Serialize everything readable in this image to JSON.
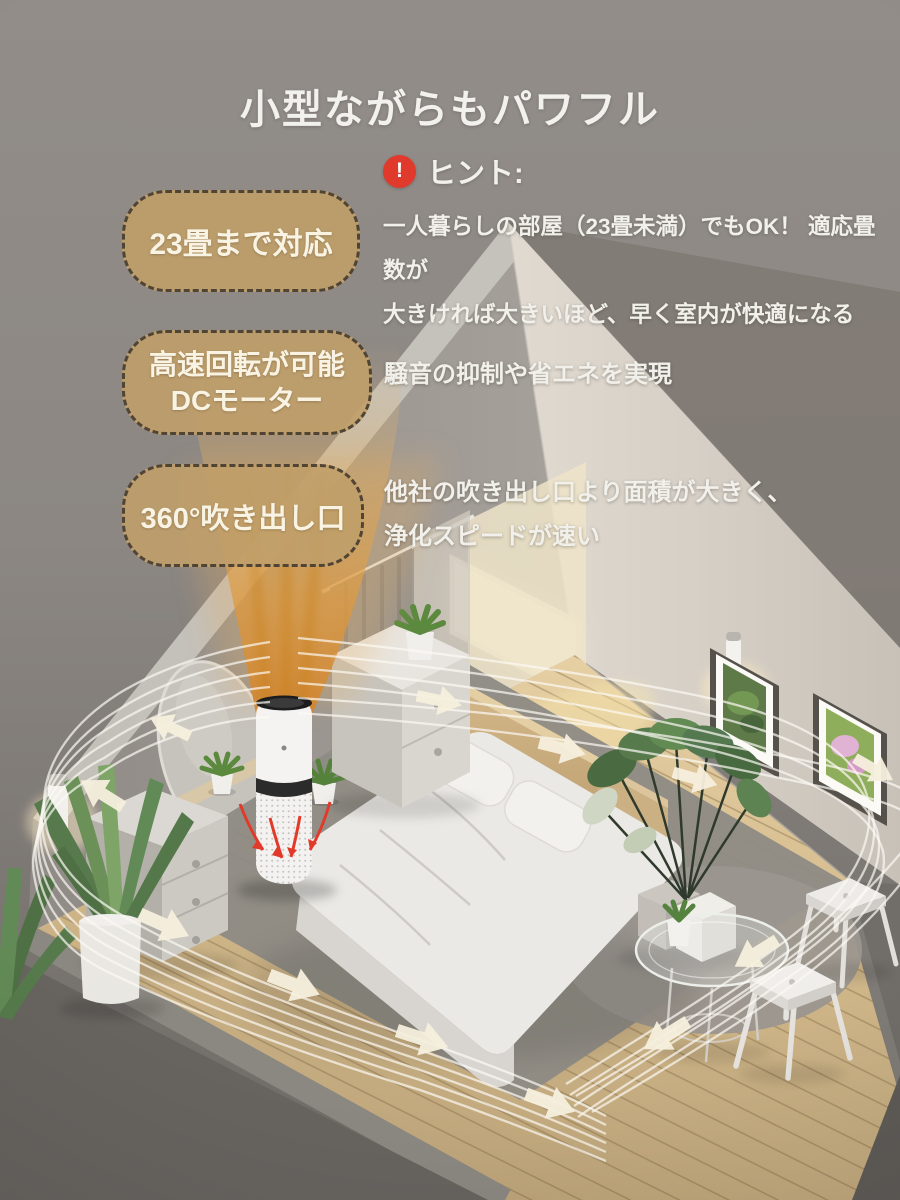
{
  "page": {
    "title": "小型ながらもパワフル"
  },
  "hint": {
    "icon": "exclamation-icon",
    "glyph": "!",
    "label": "ヒント:",
    "line1": "一人暮らしの部屋（23畳未満）でもOK！ 適応畳数が",
    "line2": "大きければ大きいほど、早く室内が快適になる"
  },
  "features": [
    {
      "badge_line1": "23畳まで対応",
      "badge_line2": "",
      "desc_line1": "",
      "desc_line2": ""
    },
    {
      "badge_line1": "高速回転が可能",
      "badge_line2": "DCモーター",
      "desc_line1": "騒音の抑制や省エネを実現",
      "desc_line2": ""
    },
    {
      "badge_line1": "360°吹き出し口",
      "badge_line2": "",
      "desc_line1": "他社の吹き出し口より面積が大きく、",
      "desc_line2": "浄化スピードが速い"
    }
  ],
  "colors": {
    "background_top": "#918c88",
    "background_bottom": "#6e6a66",
    "badge_fill": "#bf9e6a",
    "badge_border": "#3e3830",
    "badge_text": "#f9f3e3",
    "hint_red": "#e03a2c",
    "text_white": "#f2f0ea",
    "airflow_orange": "#de9a3c",
    "streamline_white": "#fcfaf4",
    "floor_wood": "#d2ba8e",
    "back_wall": "#d7d1c8",
    "left_wall": "#9d9892",
    "rug_grey": "#8f8b85"
  },
  "scene": {
    "objects": [
      "air-purifier",
      "airflow-plume",
      "airflow-streamlines",
      "airflow-arrows",
      "intake-arrows",
      "bed",
      "headboard",
      "pillows",
      "nightstand",
      "dresser",
      "mirror",
      "curtain",
      "window",
      "wall-sconce",
      "picture-frame-foliage",
      "picture-frame-flower",
      "monstera-plant",
      "yucca-plant",
      "succulent-plants",
      "glass-side-table",
      "stool",
      "round-rug",
      "area-rug",
      "wood-floor"
    ]
  }
}
